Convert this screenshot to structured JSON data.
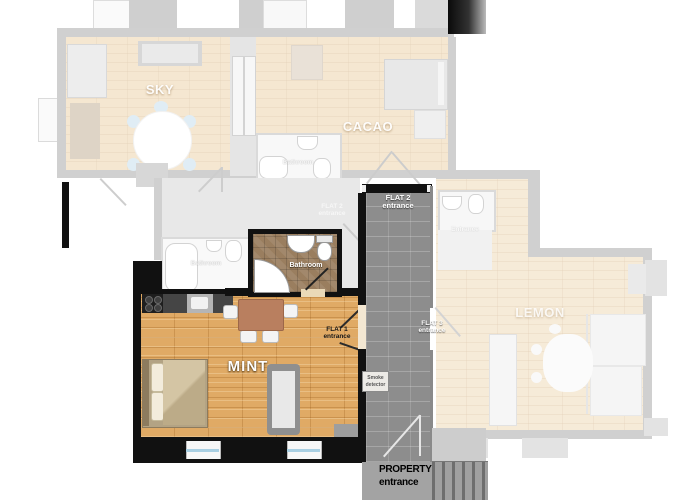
{
  "flats": {
    "sky": {
      "name": "SKY"
    },
    "cacao": {
      "name": "CACAO",
      "bathroom_label": "Bathroom"
    },
    "mint": {
      "name": "MINT",
      "bathroom_label": "Bathroom",
      "entrance": {
        "line1": "FLAT 1",
        "line2": "entrance"
      }
    },
    "lemon": {
      "name": "LEMON",
      "entrance_room_label": "Entrance",
      "entrance": {
        "line1": "FLAT 3",
        "line2": "entrance"
      }
    }
  },
  "hall": {
    "bathroom_label": "Bathroom",
    "flat2_entrance": {
      "line1": "FLAT 2",
      "line2": "entrance"
    }
  },
  "corridor": {
    "flat2_entrance": {
      "line1": "FLAT 2",
      "line2": "entrance"
    },
    "service_box": {
      "line1": "Smoke",
      "line2": "detector"
    },
    "property_entrance": {
      "line1": "PROPERTY",
      "line2": "entrance"
    }
  },
  "colors": {
    "wood": "#e0aa65",
    "wood_faded": "#e9c894",
    "wall_black": "#111111",
    "wall_gray": "#909090",
    "corridor_brick": "#8d8d8d",
    "bath_tile": "#9a7e5f",
    "window_blue": "#a9cfe2",
    "chair_blue": "#b7d6e8"
  }
}
